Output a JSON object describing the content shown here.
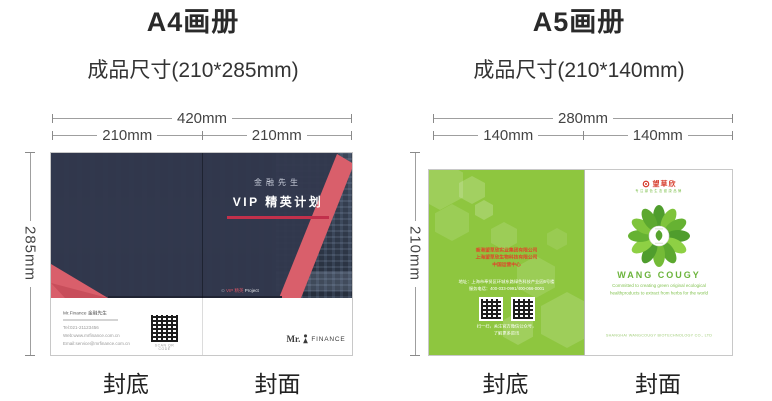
{
  "panels": [
    {
      "title": "A4画册",
      "subtitle": "成品尺寸(210*285mm)",
      "dim_total": "420mm",
      "dim_left": "210mm",
      "dim_right": "210mm",
      "dim_height": "285mm",
      "label_back": "封底",
      "label_front": "封面"
    },
    {
      "title": "A5画册",
      "subtitle": "成品尺寸(210*140mm)",
      "dim_total": "280mm",
      "dim_left": "140mm",
      "dim_right": "140mm",
      "dim_height": "210mm",
      "label_back": "封底",
      "label_front": "封面"
    }
  ],
  "a4_cover": {
    "brand_small": "金融先生",
    "brand_title": "VIP 精英计划",
    "tagline_icon": "⊙",
    "tagline_red": "VIP 精英",
    "tagline_white": "Project",
    "contact_name": "Mr.Finance 金融先生",
    "contact_lines": [
      "Tel:021-21123456",
      "Web:www.mrfinance.com.cn",
      "Email:service@mrfinance.com.cn"
    ],
    "qr_caption": "SCAN QR CODE",
    "logo_prefix": "Mr.",
    "logo_suffix": "FINANCE"
  },
  "a5_cover": {
    "back_company_lines": [
      "香港望草欣实业集团有限公司",
      "上海望草欣生物科技有限公司",
      "中国运营中心"
    ],
    "back_info_lines": [
      "地址：上海市奉贤区环城东路绿色科技产业园6号楼",
      "服务电话：400-033-0991/400-066-0001"
    ],
    "back_qr_caption_lines": [
      "扫一扫，关注官方微信公众号，",
      "了解更多资讯"
    ],
    "front_logo_text": "望草欣",
    "front_logo_tagline": "专注绿色生态健康品牌",
    "front_brand": "WANG COUGY",
    "front_slogan_lines": [
      "Committed to creating green original ecological",
      "healthproducts to extract from herbs  for the world"
    ],
    "front_company": "SHANGHAI WANGCOUGY BIOTECHNOLOGY CO., LTD"
  },
  "colors": {
    "navy_overlay": "#32384e",
    "ribbon_red": "#d95f6b",
    "underline_red": "#c2304b",
    "leaf_green": "#8ec63f",
    "brand_green": "#6cb43c",
    "company_red": "#e0452a"
  }
}
